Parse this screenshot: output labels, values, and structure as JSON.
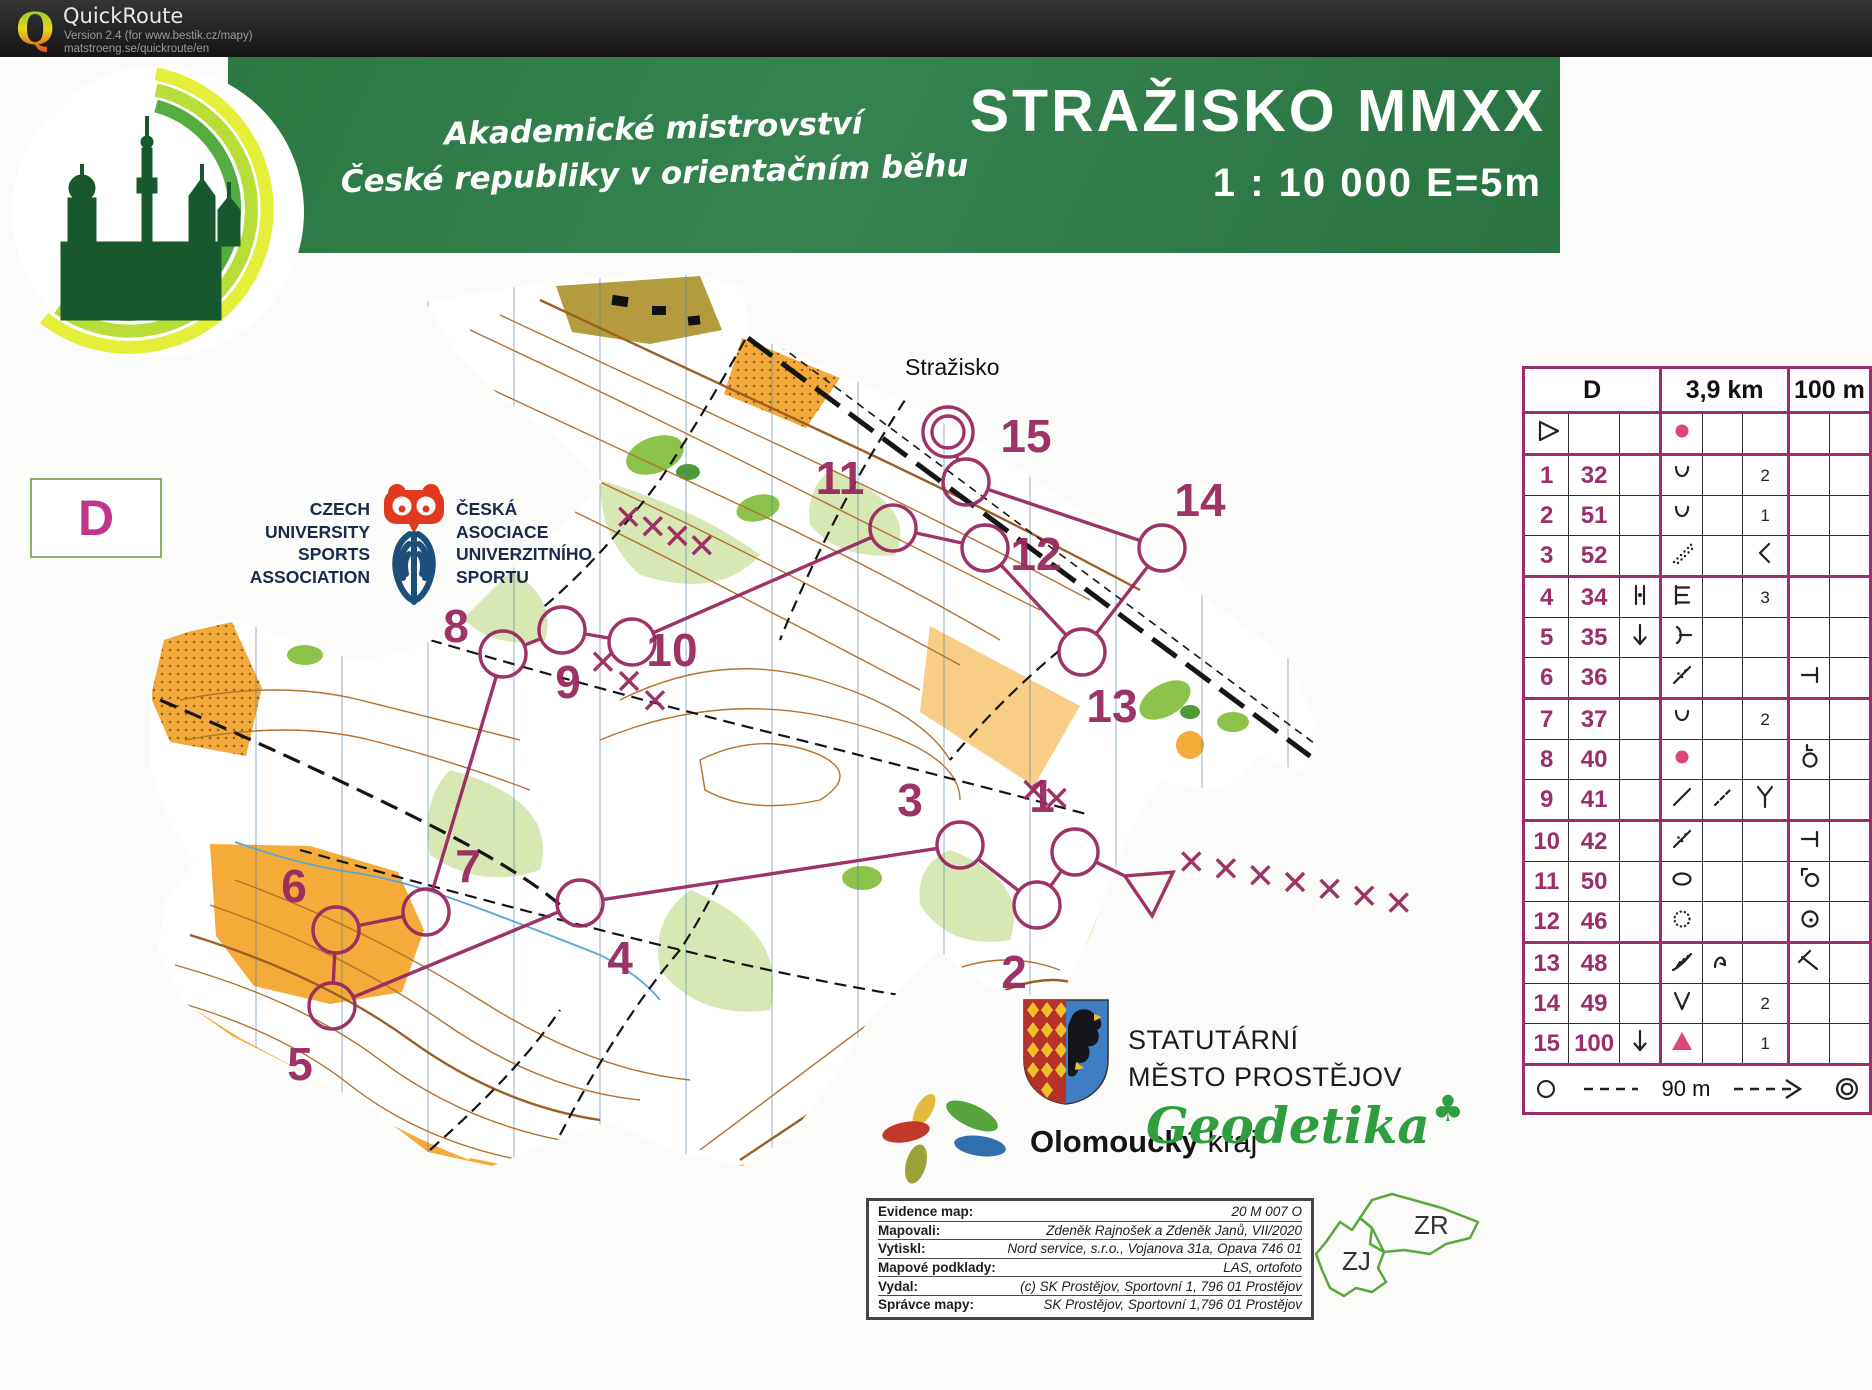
{
  "header": {
    "app_title": "QuickRoute",
    "version_line": "Version 2.4  (for www.bestik.cz/mapy)",
    "url_line": "matstroeng.se/quickroute/en"
  },
  "banner": {
    "event_line1": "Akademické mistrovství",
    "event_line2": "České republiky v orientačním běhu",
    "map_title": "STRAŽISKO MMXX",
    "scale_line": "1 : 10 000  E=5m"
  },
  "class_box": {
    "label": "D"
  },
  "cusa": {
    "left_lines": [
      "CZECH",
      "UNIVERSITY",
      "SPORTS",
      "ASSOCIATION"
    ],
    "right_lines": [
      "ČESKÁ",
      "ASOCIACE",
      "UNIVERZITNÍHO",
      "SPORTU"
    ]
  },
  "map": {
    "place_label": "Stražisko",
    "course": {
      "color": "#98295f",
      "start": {
        "x": 1150,
        "y": 888
      },
      "finish": {
        "x": 948,
        "y": 432
      },
      "controls": [
        {
          "n": "1",
          "x": 1075,
          "y": 852,
          "lx": 1042,
          "ly": 796
        },
        {
          "n": "2",
          "x": 1037,
          "y": 905,
          "lx": 1014,
          "ly": 972
        },
        {
          "n": "3",
          "x": 960,
          "y": 845,
          "lx": 910,
          "ly": 800
        },
        {
          "n": "4",
          "x": 580,
          "y": 903,
          "lx": 620,
          "ly": 958
        },
        {
          "n": "5",
          "x": 332,
          "y": 1006,
          "lx": 300,
          "ly": 1064
        },
        {
          "n": "6",
          "x": 336,
          "y": 930,
          "lx": 294,
          "ly": 886
        },
        {
          "n": "7",
          "x": 426,
          "y": 912,
          "lx": 468,
          "ly": 866
        },
        {
          "n": "8",
          "x": 503,
          "y": 654,
          "lx": 456,
          "ly": 626
        },
        {
          "n": "9",
          "x": 562,
          "y": 630,
          "lx": 568,
          "ly": 682
        },
        {
          "n": "10",
          "x": 632,
          "y": 642,
          "lx": 672,
          "ly": 650
        },
        {
          "n": "11",
          "x": 893,
          "y": 528,
          "lx": 840,
          "ly": 478
        },
        {
          "n": "12",
          "x": 985,
          "y": 548,
          "lx": 1036,
          "ly": 554
        },
        {
          "n": "13",
          "x": 1082,
          "y": 652,
          "lx": 1112,
          "ly": 706
        },
        {
          "n": "14",
          "x": 1162,
          "y": 548,
          "lx": 1200,
          "ly": 500
        },
        {
          "n": "15",
          "x": 966,
          "y": 482,
          "lx": 1026,
          "ly": 436
        }
      ],
      "x_chains": [
        {
          "x1": 616,
          "y1": 512,
          "x2": 714,
          "y2": 550,
          "count": 4
        },
        {
          "x1": 590,
          "y1": 652,
          "x2": 668,
          "y2": 710,
          "count": 3
        },
        {
          "x1": 1022,
          "y1": 786,
          "x2": 1068,
          "y2": 802,
          "count": 2
        },
        {
          "x1": 1174,
          "y1": 858,
          "x2": 1416,
          "y2": 906,
          "count": 7
        }
      ]
    }
  },
  "descriptions": {
    "header": {
      "class": "D",
      "length": "3,9 km",
      "climb": "100 m"
    },
    "rows": [
      {
        "a": "start",
        "b": "",
        "c": "",
        "d": "knoll",
        "e": "",
        "f": "",
        "g": "",
        "h": ""
      },
      {
        "a": "1",
        "b": "32",
        "c": "",
        "d": "u",
        "e": "",
        "f": "2",
        "g": "",
        "h": ""
      },
      {
        "a": "2",
        "b": "51",
        "c": "",
        "d": "u",
        "e": "",
        "f": "1",
        "g": "",
        "h": ""
      },
      {
        "a": "3",
        "b": "52",
        "c": "",
        "d": "dotslope",
        "e": "",
        "f": "lt",
        "g": "",
        "h": ""
      },
      {
        "a": "4",
        "b": "34",
        "c": "between",
        "d": "cliff",
        "e": "",
        "f": "3",
        "g": "",
        "h": ""
      },
      {
        "a": "5",
        "b": "35",
        "c": "down",
        "d": "spur",
        "e": "",
        "f": "",
        "g": "",
        "h": ""
      },
      {
        "a": "6",
        "b": "36",
        "c": "",
        "d": "dotline",
        "e": "",
        "f": "",
        "g": "tside",
        "h": ""
      },
      {
        "a": "7",
        "b": "37",
        "c": "",
        "d": "u",
        "e": "",
        "f": "2",
        "g": "",
        "h": ""
      },
      {
        "a": "8",
        "b": "40",
        "c": "",
        "d": "knoll",
        "e": "",
        "f": "",
        "g": "circlel",
        "h": ""
      },
      {
        "a": "9",
        "b": "41",
        "c": "",
        "d": "line",
        "e": "dashline",
        "f": "y",
        "g": "",
        "h": ""
      },
      {
        "a": "10",
        "b": "42",
        "c": "",
        "d": "dotline",
        "e": "",
        "f": "",
        "g": "tside",
        "h": ""
      },
      {
        "a": "11",
        "b": "50",
        "c": "",
        "d": "ellipse",
        "e": "",
        "f": "",
        "g": "cornercircle",
        "h": ""
      },
      {
        "a": "12",
        "b": "46",
        "c": "",
        "d": "dotcircle",
        "e": "",
        "f": "",
        "g": "circledot",
        "h": ""
      },
      {
        "a": "13",
        "b": "48",
        "c": "",
        "d": "earthbank",
        "e": "bend",
        "f": "",
        "g": "anglet",
        "h": ""
      },
      {
        "a": "14",
        "b": "49",
        "c": "",
        "d": "v",
        "e": "",
        "f": "2",
        "g": "",
        "h": ""
      },
      {
        "a": "15",
        "b": "100",
        "c": "down",
        "d": "boulder",
        "e": "",
        "f": "1",
        "g": "",
        "h": ""
      }
    ],
    "finish": {
      "distance": "90 m"
    }
  },
  "evidence": {
    "rows": [
      {
        "label": "Evidence map:",
        "value": "20 M 007 O"
      },
      {
        "label": "Mapovali:",
        "value": "Zdeněk Rajnošek a Zdeněk Janů, VII/2020"
      },
      {
        "label": "Vytiskl:",
        "value": "Nord service, s.r.o., Vojanova 31a, Opava  746 01"
      },
      {
        "label": "Mapové podklady:",
        "value": "LAS, ortofoto"
      },
      {
        "label": "Vydal:",
        "value": "(c) SK Prostějov, Sportovní 1, 796 01 Prostějov"
      },
      {
        "label": "Správce mapy:",
        "value": "SK Prostějov, Sportovní 1,796 01 Prostějov"
      }
    ]
  },
  "sponsors": {
    "prostejov": {
      "line1": "STATUTÁRNÍ",
      "line2": "MĚSTO PROSTĚJOV"
    },
    "olomoucky": {
      "bold": "Olomoucký",
      "regular": " kraj"
    },
    "geodetika": {
      "name": "Geodetika"
    }
  },
  "area_logo": {
    "left_label": "ZJ",
    "right_label": "ZR"
  }
}
